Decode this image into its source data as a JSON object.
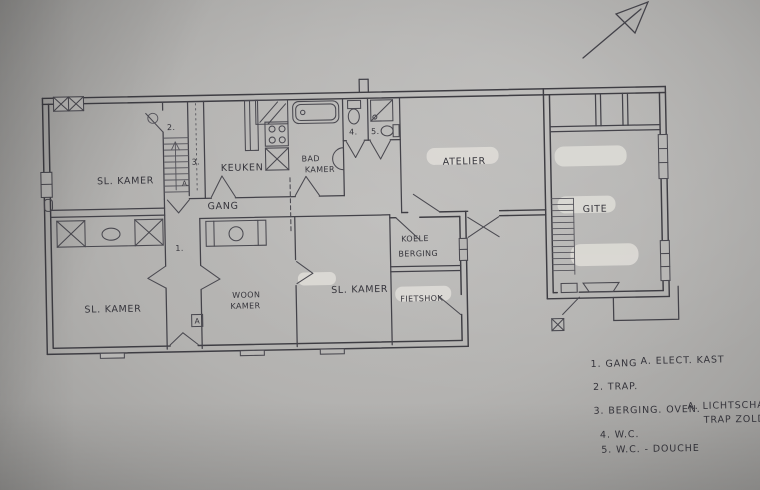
{
  "colors": {
    "paper": "#b3b2b0",
    "ink": "#3e3d43",
    "whiteout": "#dfddd8"
  },
  "rooms": {
    "sl_kamer_top": "SL. KAMER",
    "keuken": "KEUKEN",
    "bad_line1": "BAD",
    "bad_line2": "KAMER",
    "atelier": "ATELIER",
    "gite": "GITE",
    "gang": "GANG",
    "woon_line1": "WOON",
    "woon_line2": "KAMER",
    "sl_kamer_mid": "SL. KAMER",
    "koele_line1": "KOELE",
    "koele_line2": "BERGING",
    "fietshok": "FIETSHOK",
    "sl_kamer_bottom": "SL. KAMER"
  },
  "markers": {
    "n1": "1.",
    "n2": "2.",
    "n3": "3.",
    "n4": "4.",
    "n5": "5.",
    "a_stairs": "A.",
    "a_kast": "A"
  },
  "legend": {
    "items": [
      {
        "label": "1. GANG",
        "note": "A. ELECT. KAST"
      },
      {
        "label": "2. TRAP."
      },
      {
        "label": "3. BERGING. OVEN.",
        "note": "A. LICHTSCHAKEL",
        "note2": "TRAP ZOLDER"
      },
      {
        "label": "4. W.C."
      },
      {
        "label": "5. W.C. - DOUCHE"
      }
    ]
  }
}
